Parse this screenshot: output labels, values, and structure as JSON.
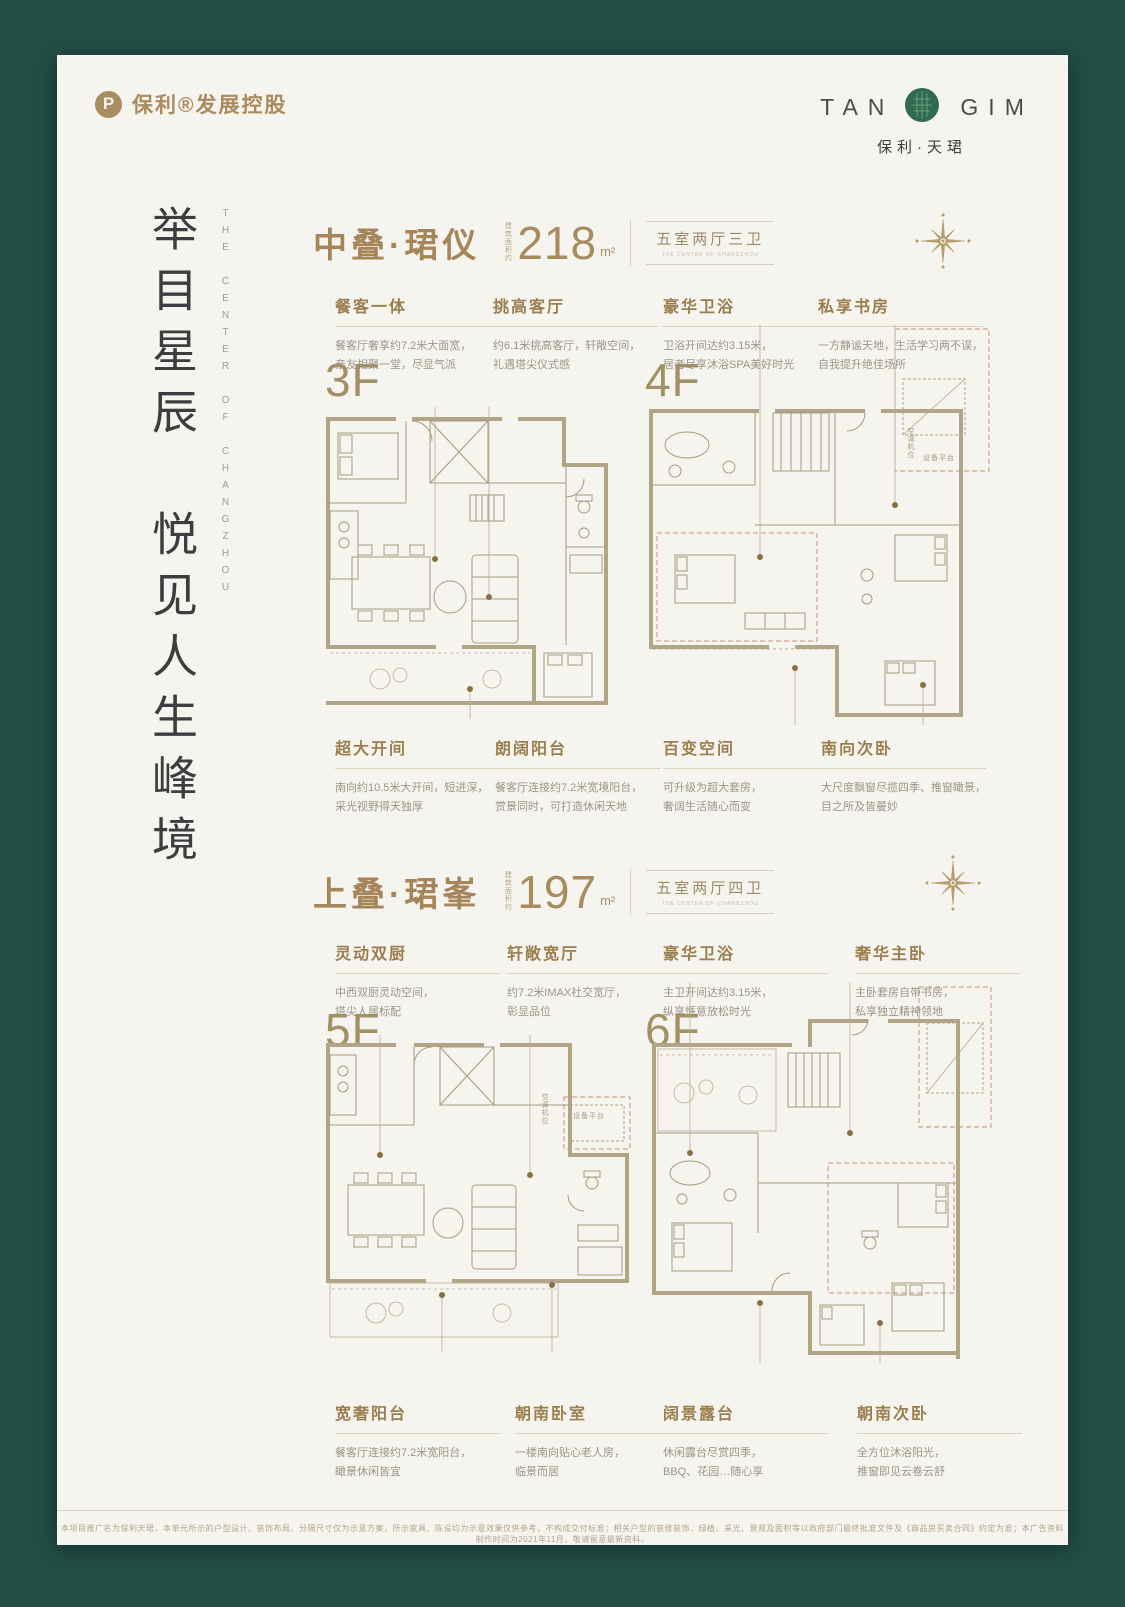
{
  "brand": {
    "mark": "P",
    "name": "保利®发展控股"
  },
  "project": {
    "logo_left": "TAN",
    "logo_right": "GIM",
    "name": "保利·天珺"
  },
  "hero": {
    "headline": "举目星辰　悦见人生峰境",
    "headline_en": "THE CENTER OF CHANGZHOU"
  },
  "plan_annotations": {
    "ac_unit": "空调机位",
    "equipment": "设备平台"
  },
  "sections": [
    {
      "title": "中叠·珺仪",
      "area_prefix": "建筑面积约",
      "area_value": "218",
      "area_unit": "m²",
      "spec": "五室两厅三卫",
      "spec_sub": "THE CENTER OF CHANGZHOU",
      "floors": [
        "3F",
        "4F"
      ],
      "features_top": [
        {
          "title": "餐客一体",
          "desc": "餐客厅奢享约7.2米大面宽，\n亲友相聚一堂，尽显气派"
        },
        {
          "title": "挑高客厅",
          "desc": "约6.1米挑高客厅，轩敞空间，\n礼遇塔尖仪式感"
        },
        {
          "title": "豪华卫浴",
          "desc": "卫浴开间达约3.15米，\n居者尽享沐浴SPA美好时光"
        },
        {
          "title": "私享书房",
          "desc": "一方静谧天地，生活学习两不误，\n自我提升绝佳场所"
        }
      ],
      "features_bottom": [
        {
          "title": "超大开间",
          "desc": "南向约10.5米大开间，短进深，\n采光视野得天独厚"
        },
        {
          "title": "朗阔阳台",
          "desc": "餐客厅连接约7.2米宽境阳台，\n赏景同时，可打造休闲天地"
        },
        {
          "title": "百变空间",
          "desc": "可升级为超大套房，\n奢阔生活随心而变"
        },
        {
          "title": "南向次卧",
          "desc": "大尺度飘窗尽揽四季、推窗瞰景，\n目之所及皆曼妙"
        }
      ]
    },
    {
      "title": "上叠·珺峯",
      "area_prefix": "建筑面积约",
      "area_value": "197",
      "area_unit": "m²",
      "spec": "五室两厅四卫",
      "spec_sub": "THE CENTER OF CHANGZHOU",
      "floors": [
        "5F",
        "6F"
      ],
      "features_top": [
        {
          "title": "灵动双厨",
          "desc": "中西双厨灵动空间，\n塔尖人居标配"
        },
        {
          "title": "轩敞宽厅",
          "desc": "约7.2米IMAX社交宽厅，\n彰显品位"
        },
        {
          "title": "豪华卫浴",
          "desc": "主卫开间达约3.15米，\n纵享惬意放松时光"
        },
        {
          "title": "奢华主卧",
          "desc": "主卧套房自带书房，\n私享独立精神领地"
        }
      ],
      "features_bottom": [
        {
          "title": "宽奢阳台",
          "desc": "餐客厅连接约7.2米宽阳台，\n瞰景休闲皆宜"
        },
        {
          "title": "朝南卧室",
          "desc": "一楼南向贴心老人房，\n临景而居"
        },
        {
          "title": "阔景露台",
          "desc": "休闲露台尽赏四季，\nBBQ、花园…随心享"
        },
        {
          "title": "朝南次卧",
          "desc": "全方位沐浴阳光，\n推窗即见云卷云舒"
        }
      ]
    }
  ],
  "footer": {
    "disclaimer": "本项目推广名为保利天珺，本单元所示的户型设计、装饰布局、分隔尺寸仅为示意方案，所示家具、陈设均为示意效果仅供参考，不构成交付标准；相关户型的装修装饰、绿植、采光、景观及面积等以政府部门最终批准文件及《商品房买卖合同》约定为准；本广告资料制作时间为2021年11月，敬请留意最新资料。"
  }
}
